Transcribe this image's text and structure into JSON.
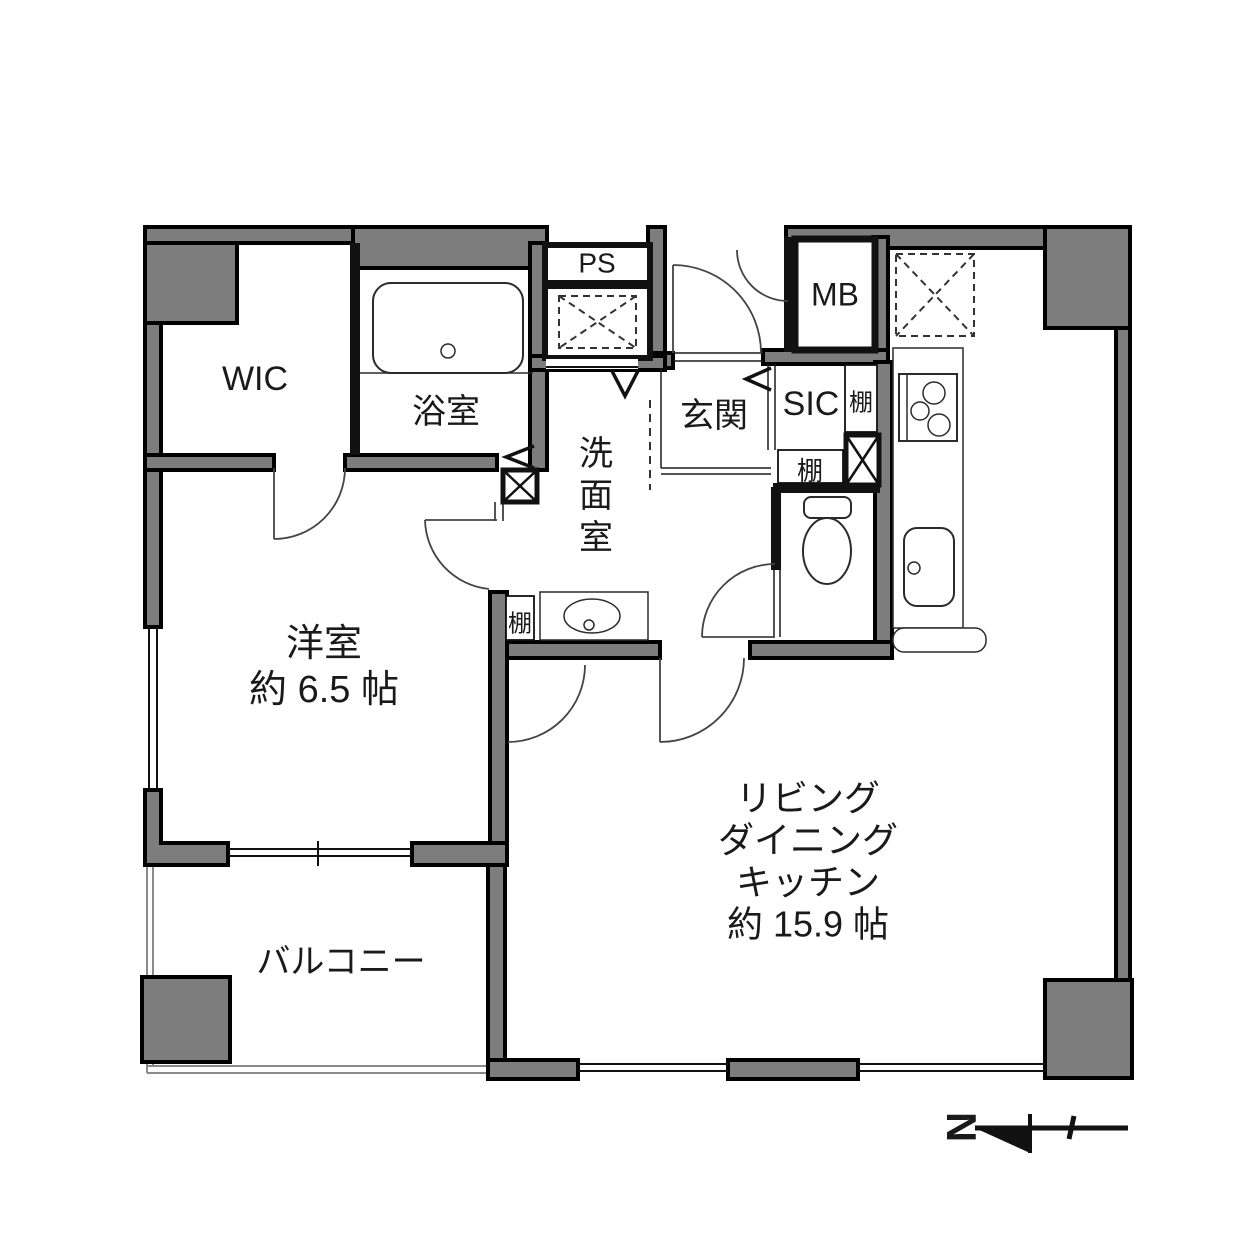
{
  "plan": {
    "rooms": {
      "wic": {
        "label": "WIC"
      },
      "bathroom": {
        "label": "浴室"
      },
      "ps": {
        "label": "PS"
      },
      "mb": {
        "label": "MB"
      },
      "genkan": {
        "label": "玄関"
      },
      "sic": {
        "label": "SIC"
      },
      "washroom": {
        "chars": [
          "洗",
          "面",
          "室"
        ]
      },
      "bedroom": {
        "label": "洋室",
        "area": "約 6.5 帖"
      },
      "ldk": {
        "lines": [
          "リビング",
          "ダイニング",
          "キッチン",
          "約 15.9 帖"
        ]
      },
      "balcony": {
        "label": "バルコニー"
      }
    },
    "shelf_label": "棚",
    "compass": {
      "label": "N"
    },
    "colors": {
      "wall": "#7d7d7d",
      "outline": "#000000",
      "background": "#ffffff"
    }
  }
}
